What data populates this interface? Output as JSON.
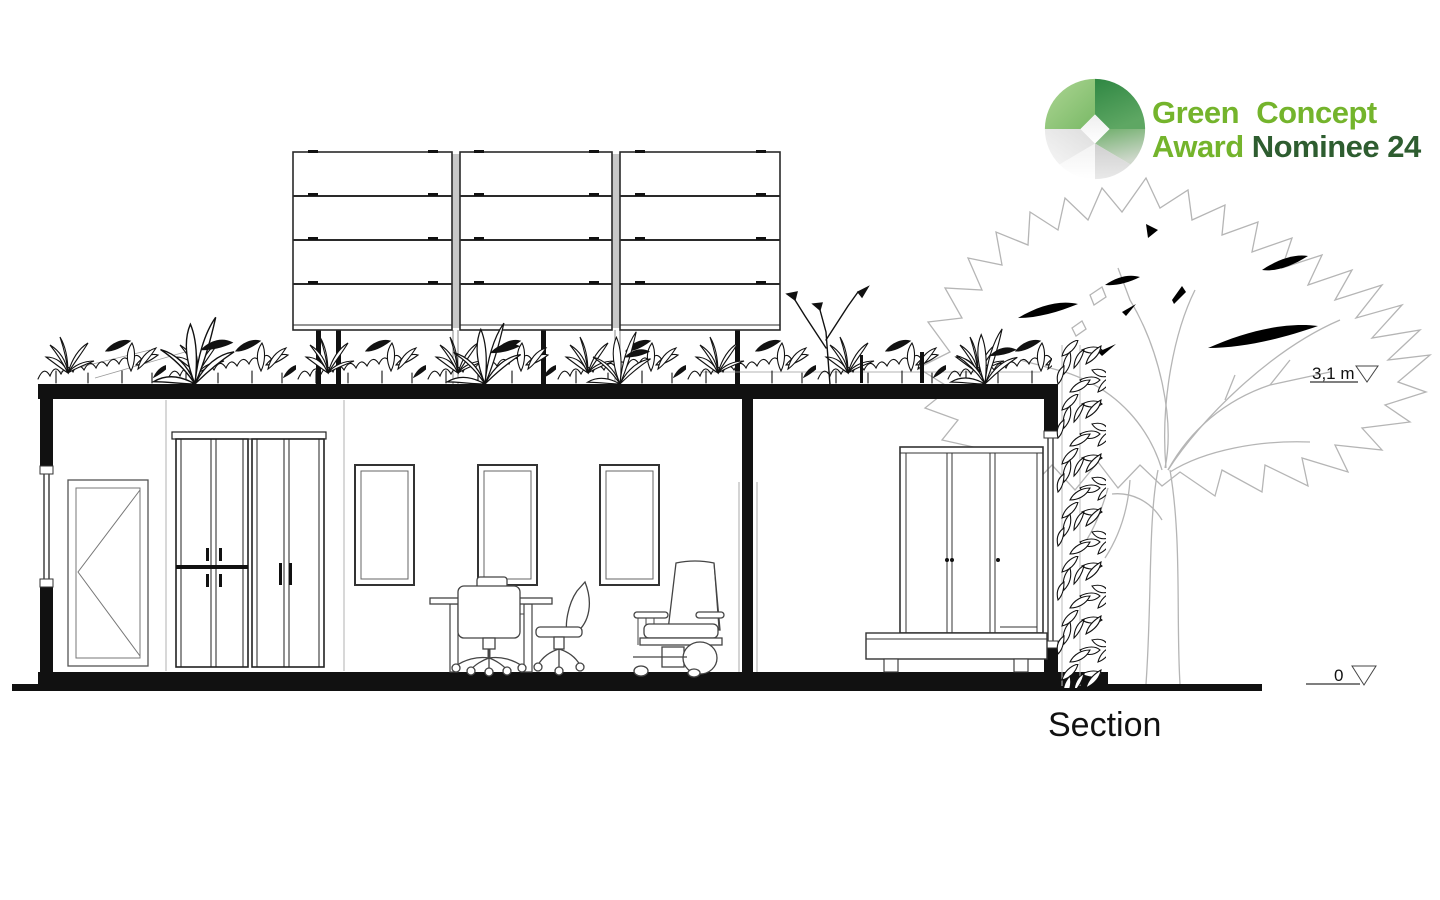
{
  "badge": {
    "line1": "Green Concept",
    "award": "Award",
    "nominee": "Nominee 24",
    "colors": {
      "light_green": "#74b42c",
      "dark_green": "#2e5d30"
    }
  },
  "drawing": {
    "title": "Section",
    "elevation_roof": "3,1 m",
    "elevation_ground": "0",
    "colors": {
      "line_black": "#111111",
      "detail_gray": "#9b9b9b",
      "tree_gray": "#b5b5b5"
    }
  }
}
